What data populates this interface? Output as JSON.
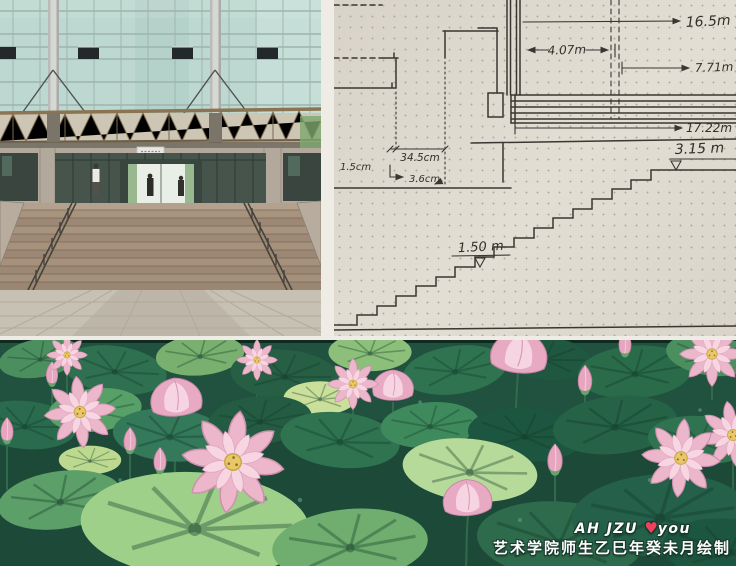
{
  "collage": {
    "panel_count": 3,
    "gutter_color": "#efece6"
  },
  "photo": {
    "desc": "glass curtain-wall building entrance with canopy and wide stone staircase"
  },
  "sketch": {
    "desc": "hand-drawn facade and staircase dimension sketch on dotted grid paper",
    "labels": {
      "overall_height": "16.5m",
      "upper_span": "4.07m",
      "mid_span": "7.71m",
      "facade_span": "17.22m",
      "upper_level": "3.15 m",
      "mid_level": "1.50 m",
      "tread": "34.5cm",
      "nosing": "1.5cm",
      "riser": "3.6cm"
    }
  },
  "mural": {
    "desc": "painted lotus pond mural with pink lotus flowers and green leaves",
    "caption_en": "AH JZU",
    "heart": "♥",
    "caption_en2": "you",
    "caption_zh": "艺术学院师生乙巳年癸未月绘制"
  },
  "colors": {
    "paper": "#dbd6cb",
    "ink": "#3a3631",
    "glass": "#bcd8d0",
    "canopy": "#8a7452",
    "concrete": "#b2a89b",
    "step_stone": "#a5917f",
    "plaza": "#c7c1b4",
    "mural_green_dark": "#1c4636",
    "leaf_light": "#9fd08a",
    "lotus_pink": "#edb7cb",
    "heart_red": "#f2415c",
    "caption_white": "#ffffff"
  }
}
